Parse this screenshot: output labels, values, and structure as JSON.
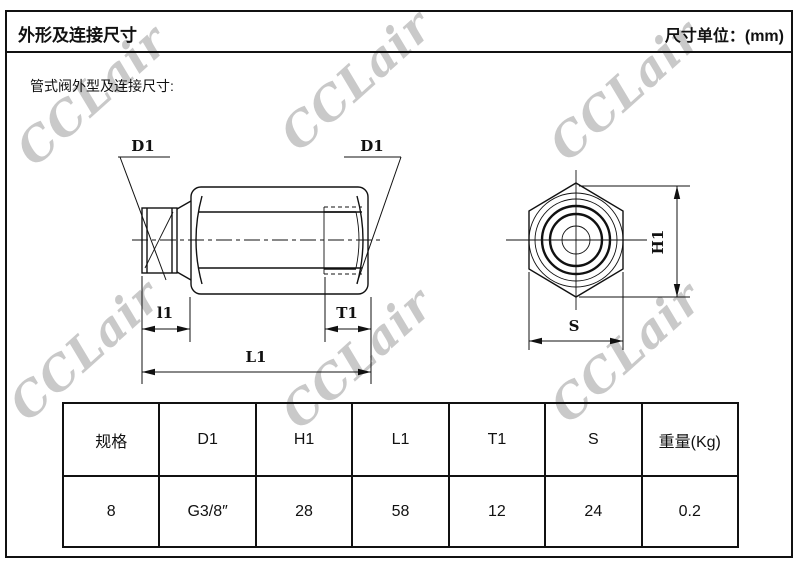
{
  "header": {
    "title": "外形及连接尺寸",
    "unit_label": "尺寸单位：(mm)"
  },
  "subtitle": "管式阀外型及连接尺寸:",
  "watermark": {
    "text": "CCLair",
    "color": "#c9c9c9"
  },
  "drawing": {
    "labels": {
      "d1_left": "D1",
      "d1_right": "D1",
      "l1": "l1",
      "t1": "T1",
      "l1_total": "L1",
      "h1": "H1",
      "s": "S"
    }
  },
  "table": {
    "headers": [
      "规格",
      "D1",
      "H1",
      "L1",
      "T1",
      "S",
      "重量(Kg)"
    ],
    "rows": [
      [
        "8",
        "G3/8″",
        "28",
        "58",
        "12",
        "24",
        "0.2"
      ]
    ]
  }
}
